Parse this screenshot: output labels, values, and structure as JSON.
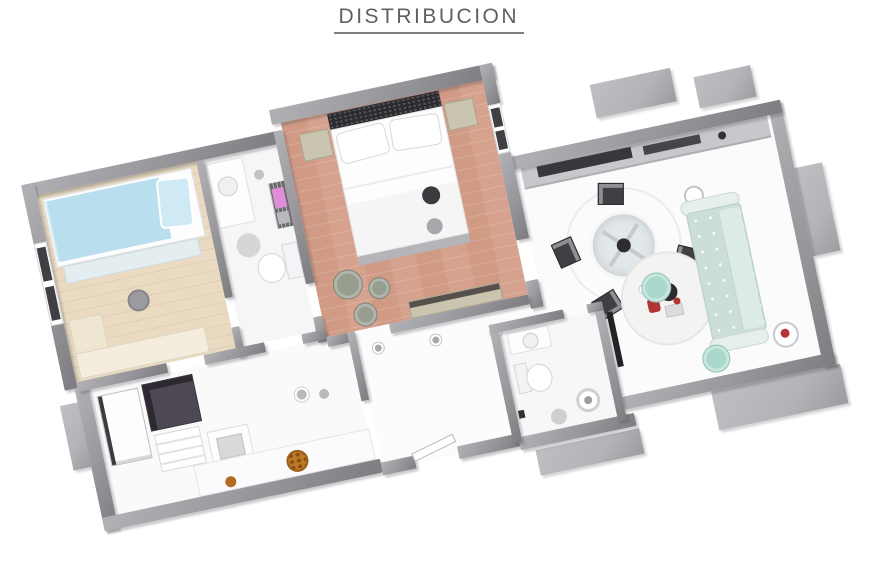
{
  "title": "DISTRIBUCION",
  "colors": {
    "background": "#ffffff",
    "title_text": "#5f5f64",
    "wall": "#97979b",
    "wall_light": "#b2b2b6",
    "wall_dark": "#7d7d81",
    "slab": "#b4b4b8",
    "floor_white": "#fbfbfb",
    "floor_wood_light": "#e9dac1",
    "floor_terracotta": "#d7a28d",
    "bed_blue": "#b9dfee",
    "pillow_blue": "#cfeaf5",
    "sofa_mint": "#cbdfd8",
    "pouf_mint": "#abd8cc",
    "towel_pink": "#e08ed7",
    "accent_red": "#b23434",
    "accent_orange": "#bf7a28",
    "furniture_dark": "#3a3a3f",
    "nightstand_beige": "#c9c5ae",
    "pouf_green_gray": "#979d8f",
    "glass": "#e2e7e9"
  },
  "scene": {
    "type": "3d-floor-plan-render",
    "rooms": [
      "small-bedroom",
      "bathroom-1",
      "main-bedroom",
      "kitchen",
      "hallway",
      "bathroom-2",
      "living-dining"
    ],
    "furniture": [
      "single-bed-blue",
      "desk",
      "stool",
      "vanity",
      "toilet",
      "towel-rack-pink",
      "double-bed",
      "nightstands",
      "woven-poufs",
      "bench",
      "kitchen-counter",
      "dining-table-glass",
      "dining-chairs",
      "mint-sofa",
      "mint-poufs",
      "round-rug",
      "side-table",
      "fridge",
      "washer",
      "sink-island",
      "fruit-bowl",
      "shower-drain"
    ]
  }
}
